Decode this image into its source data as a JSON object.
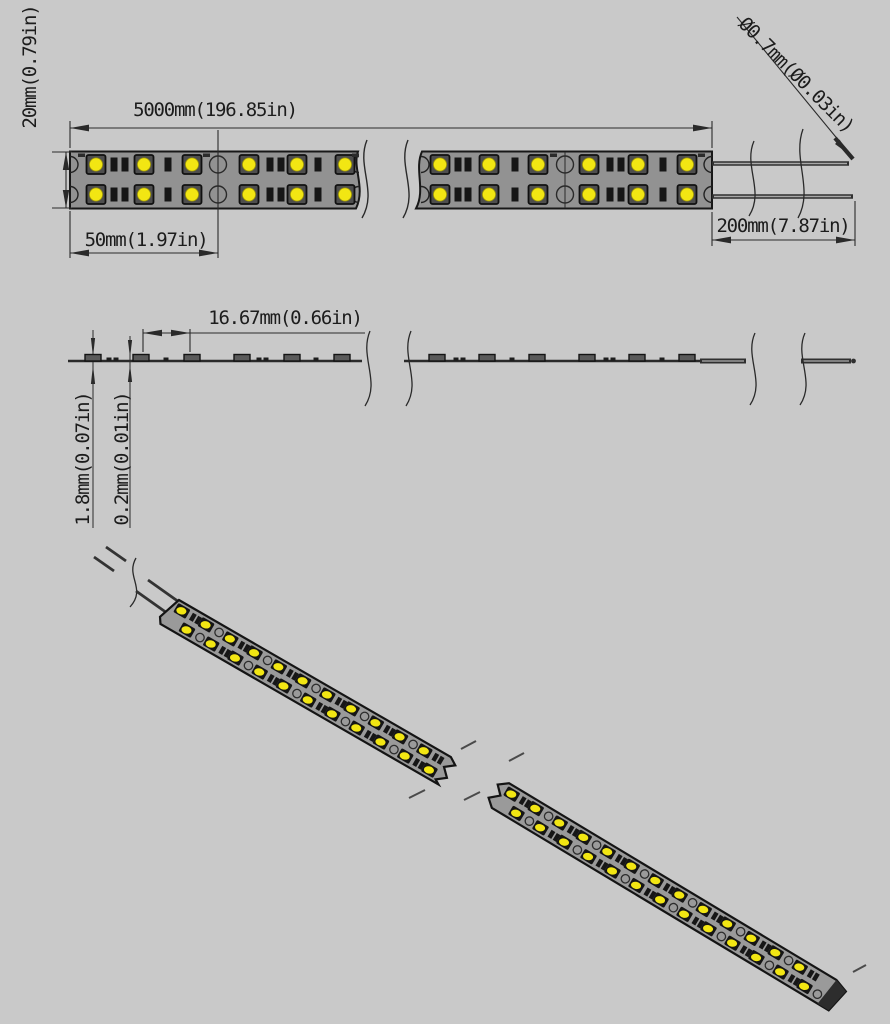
{
  "drawing": {
    "colors": {
      "background": "#c9c9c9",
      "line": "#2a2a2a",
      "strip_body": "#929292",
      "led_package": "#4e4e4e",
      "led_yellow": "#f2e613",
      "component_black": "#161616",
      "bump_gray": "#5a5a5a",
      "wire_dark": "#303030",
      "wire_core": "#a8a8a8"
    },
    "labels": {
      "strip_width": "20mm(0.79in)",
      "strip_length": "5000mm(196.85in)",
      "cut_segment": "50mm(1.97in)",
      "wire_length": "200mm(7.87in)",
      "wire_diameter": "Ø0.7mm(Ø0.03in)",
      "led_pitch": "16.67mm(0.66in)",
      "total_thickness": "1.8mm(0.07in)",
      "pcb_thickness": "0.2mm(0.01in)"
    }
  }
}
